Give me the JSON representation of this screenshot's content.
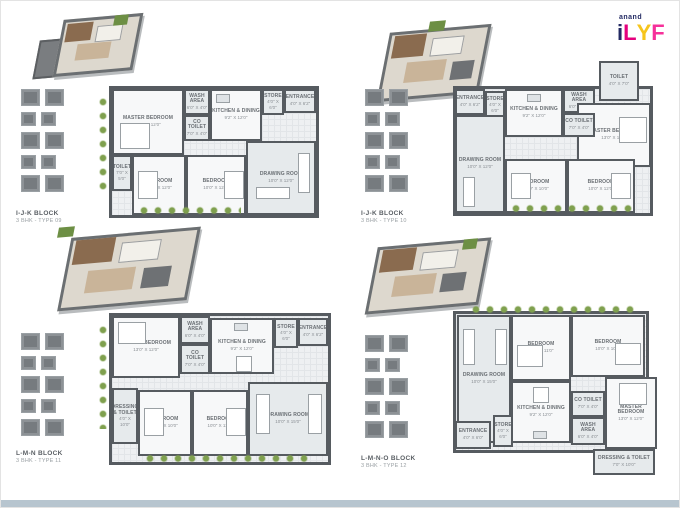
{
  "logo": {
    "brand": "anand",
    "name": "iLYF",
    "letters": [
      "i",
      "L",
      "Y",
      "F"
    ],
    "letter_colors": [
      "#232a63",
      "#e5007d",
      "#f6c51c",
      "#f6309a"
    ],
    "brand_color": "#232a63"
  },
  "palette": {
    "wall": "#565b60",
    "floor": "#eef0f2",
    "shrub_green": "#7fa04e",
    "bottom_bar": "#b7c5cf"
  },
  "plans": [
    {
      "block": "I-J-K BLOCK",
      "unit": "3 BHK - TYPE 09",
      "rooms": [
        {
          "name": "MASTER BEDROOM",
          "size": "13'0\" X 12'0\""
        },
        {
          "name": "WASH AREA",
          "size": "6'0\" X 4'0\""
        },
        {
          "name": "CO TOILET",
          "size": "7'0\" X 4'0\""
        },
        {
          "name": "KITCHEN & DINING",
          "size": "9'2\" X 12'0\""
        },
        {
          "name": "STORE",
          "size": "4'0\" X 6'0\""
        },
        {
          "name": "ENTRANCE",
          "size": "4'0\" X 6'2\""
        },
        {
          "name": "TOILET",
          "size": "7'0\" X 5'0\""
        },
        {
          "name": "BEDROOM",
          "size": "10'0\" X 12'0\""
        },
        {
          "name": "BEDROOM",
          "size": "10'0\" X 12'0\""
        },
        {
          "name": "DRAWING ROOM",
          "size": "10'0\" X 12'0\""
        }
      ]
    },
    {
      "block": "I-J-K BLOCK",
      "unit": "3 BHK - TYPE 10",
      "rooms": [
        {
          "name": "ENTRANCE",
          "size": "4'0\" X 6'2\""
        },
        {
          "name": "STORE",
          "size": "4'0\" X 6'0\""
        },
        {
          "name": "KITCHEN & DINING",
          "size": "9'2\" X 12'0\""
        },
        {
          "name": "WASH AREA",
          "size": "6'0\" X 4'0\""
        },
        {
          "name": "TOILET",
          "size": "4'0\" X 7'0\""
        },
        {
          "name": "MASTER BEDROOM",
          "size": "13'0\" X 12'0\""
        },
        {
          "name": "CO TOILET",
          "size": "7'0\" X 4'0\""
        },
        {
          "name": "DRAWING ROOM",
          "size": "10'0\" X 12'0\""
        },
        {
          "name": "BEDROOM",
          "size": "10'0\" X 10'0\""
        },
        {
          "name": "BEDROOM",
          "size": "10'0\" X 12'0\""
        }
      ]
    },
    {
      "block": "L-M-N BLOCK",
      "unit": "3 BHK - TYPE 11",
      "rooms": [
        {
          "name": "MASTER BEDROOM",
          "size": "13'0\" X 12'0\""
        },
        {
          "name": "WASH AREA",
          "size": "6'0\" X 4'0\""
        },
        {
          "name": "CO TOILET",
          "size": "7'0\" X 4'0\""
        },
        {
          "name": "KITCHEN & DINING",
          "size": "9'2\" X 12'0\""
        },
        {
          "name": "STORE",
          "size": "4'0\" X 6'0\""
        },
        {
          "name": "ENTRANCE",
          "size": "4'0\" X 6'2\""
        },
        {
          "name": "DRESSING & TOILET",
          "size": "4'0\" X 10'0\""
        },
        {
          "name": "BEDROOM",
          "size": "10'0\" X 10'0\""
        },
        {
          "name": "BEDROOM",
          "size": "10'0\" X 11'0\""
        },
        {
          "name": "DRAWING ROOM",
          "size": "10'0\" X 15'0\""
        }
      ]
    },
    {
      "block": "L-M-N-O BLOCK",
      "unit": "3 BHK - TYPE 12",
      "rooms": [
        {
          "name": "DRAWING ROOM",
          "size": "10'0\" X 15'0\""
        },
        {
          "name": "BEDROOM",
          "size": "10'0\" X 11'0\""
        },
        {
          "name": "BEDROOM",
          "size": "10'0\" X 10'0\""
        },
        {
          "name": "KITCHEN & DINING",
          "size": "9'2\" X 12'0\""
        },
        {
          "name": "CO TOILET",
          "size": "7'0\" X 4'0\""
        },
        {
          "name": "WASH AREA",
          "size": "6'0\" X 4'0\""
        },
        {
          "name": "STORE",
          "size": "4'0\" X 6'0\""
        },
        {
          "name": "ENTRANCE",
          "size": "4'0\" X 6'0\""
        },
        {
          "name": "MASTER BEDROOM",
          "size": "13'0\" X 12'0\""
        },
        {
          "name": "DRESSING & TOILET",
          "size": "7'0\" X 10'0\""
        }
      ]
    }
  ]
}
